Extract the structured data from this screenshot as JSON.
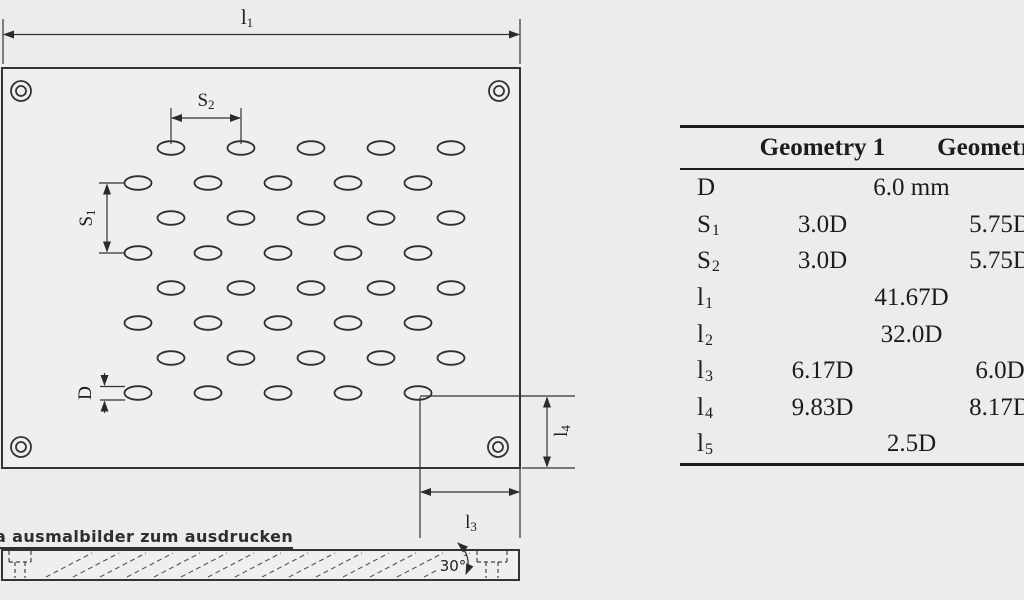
{
  "colors": {
    "background": "#ececec",
    "plate_fill": "#efefef",
    "line": "#333333",
    "text": "#1c1c1c"
  },
  "drawing": {
    "labels": {
      "l1": {
        "base": "l",
        "sub": "1"
      },
      "s2": {
        "base": "S",
        "sub": "2"
      },
      "s1": {
        "base": "S",
        "sub": "1"
      },
      "d": "D",
      "l4": {
        "base": "l",
        "sub": "4"
      },
      "l3": {
        "base": "l",
        "sub": "3"
      },
      "angle": "30°"
    },
    "caption": "a ausmalbilder zum ausdrucken"
  },
  "table": {
    "headers": {
      "col1": "Geometry 1",
      "col2": "Geometry 2"
    },
    "rows": [
      {
        "label": {
          "base": "D",
          "sub": ""
        },
        "shared": "6.0 mm"
      },
      {
        "label": {
          "base": "S",
          "sub": "1"
        },
        "g1": "3.0D",
        "g2": "5.75D"
      },
      {
        "label": {
          "base": "S",
          "sub": "2"
        },
        "g1": "3.0D",
        "g2": "5.75D"
      },
      {
        "label": {
          "base": "l",
          "sub": "1"
        },
        "shared": "41.67D"
      },
      {
        "label": {
          "base": "l",
          "sub": "2"
        },
        "shared": "32.0D"
      },
      {
        "label": {
          "base": "l",
          "sub": "3"
        },
        "g1": "6.17D",
        "g2": "6.0D"
      },
      {
        "label": {
          "base": "l",
          "sub": "4"
        },
        "g1": "9.83D",
        "g2": "8.17D"
      },
      {
        "label": {
          "base": "l",
          "sub": "5"
        },
        "shared": "2.5D"
      }
    ]
  }
}
